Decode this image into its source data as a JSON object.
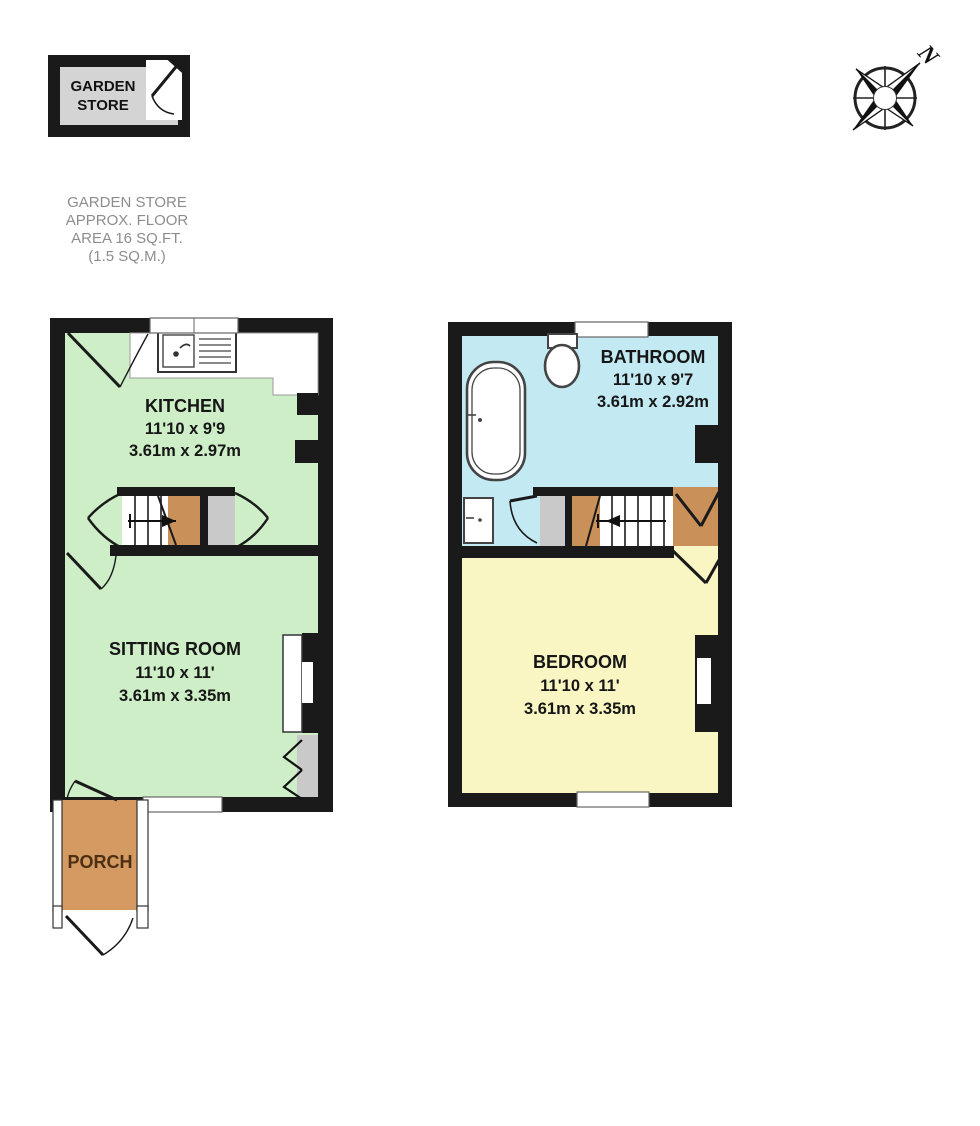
{
  "colors": {
    "wall": "#1a1a1a",
    "ground_room_green": "#cdeec6",
    "bathroom_blue": "#c3e9f2",
    "bedroom_yellow": "#f9f6c3",
    "porch_orange": "#d49a62",
    "stair_orange": "#c9905a",
    "landing_gray": "#c9c9c9",
    "store_gray": "#d4d4d4",
    "caption_gray": "#8d8d8d"
  },
  "garden_store": {
    "line1": "GARDEN",
    "line2": "STORE"
  },
  "caption": {
    "line1": "GARDEN STORE",
    "line2": "APPROX. FLOOR",
    "line3": "AREA 16 SQ.FT.",
    "line4": "(1.5 SQ.M.)"
  },
  "compass": {
    "north": "N"
  },
  "ground_floor": {
    "kitchen": {
      "name": "KITCHEN",
      "imperial": "11'10 x 9'9",
      "metric": "3.61m x 2.97m"
    },
    "sitting_room": {
      "name": "SITTING ROOM",
      "imperial": "11'10 x 11'",
      "metric": "3.61m x 3.35m"
    },
    "porch": {
      "name": "PORCH"
    },
    "fixtures": [
      "sink-unit",
      "worktop",
      "staircase-up",
      "fireplace"
    ]
  },
  "first_floor": {
    "bathroom": {
      "name": "BATHROOM",
      "imperial": "11'10 x 9'7",
      "metric": "3.61m x 2.92m"
    },
    "bedroom": {
      "name": "BEDROOM",
      "imperial": "11'10 x 11'",
      "metric": "3.61m x 3.35m"
    },
    "fixtures": [
      "bathtub",
      "toilet",
      "washbasin",
      "staircase-down",
      "chimney-breast"
    ]
  }
}
